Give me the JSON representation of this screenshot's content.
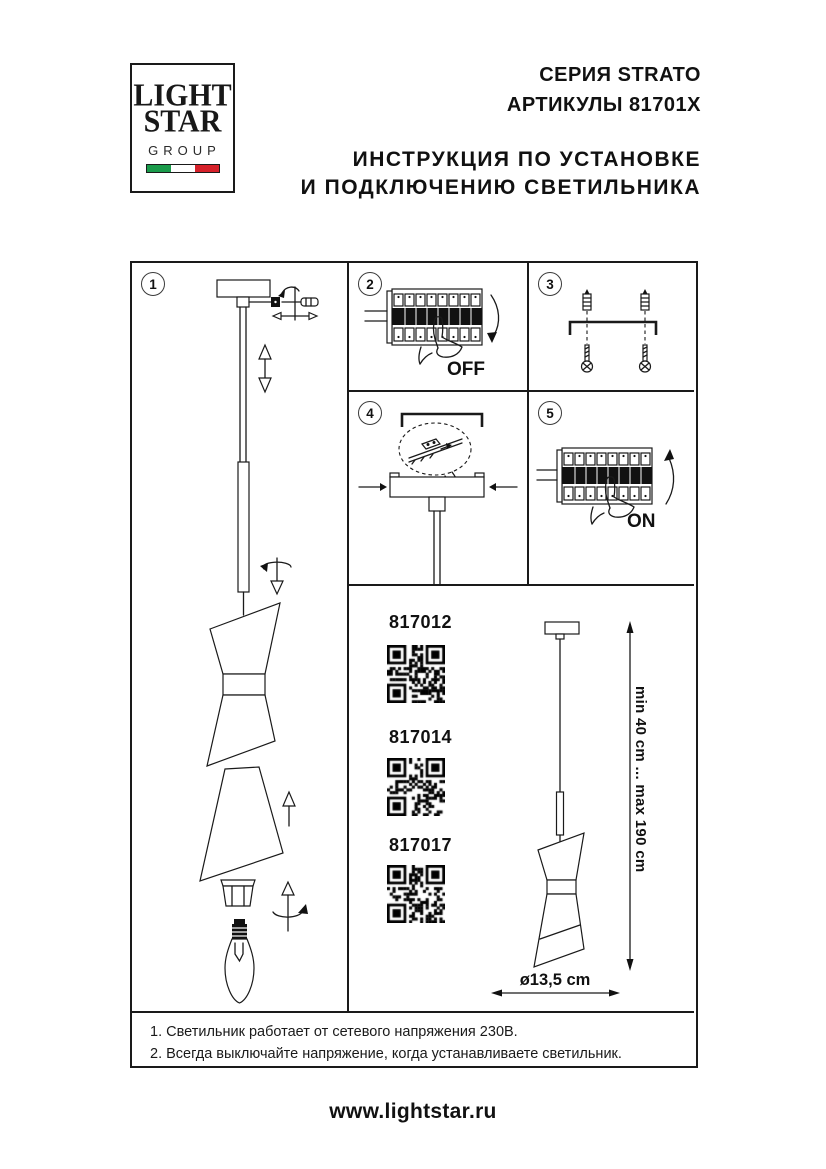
{
  "logo": {
    "line1": "LIGHT",
    "line2": "STAR",
    "line3": "GROUP",
    "flag_colors": [
      "#1a9b4b",
      "#ffffff",
      "#d6212a"
    ]
  },
  "header": {
    "series": "СЕРИЯ STRATO",
    "articles": "АРТИКУЛЫ 81701X",
    "title_line1": "ИНСТРУКЦИЯ ПО УСТАНОВКЕ",
    "title_line2": "И ПОДКЛЮЧЕНИЮ СВЕТИЛЬНИКА"
  },
  "steps": [
    {
      "number": "1"
    },
    {
      "number": "2",
      "label": "OFF"
    },
    {
      "number": "3"
    },
    {
      "number": "4"
    },
    {
      "number": "5",
      "label": "ON"
    }
  ],
  "products": [
    {
      "article": "817012"
    },
    {
      "article": "817014"
    },
    {
      "article": "817017"
    }
  ],
  "dimensions": {
    "height_range": "min 40 cm ... max 190 cm",
    "diameter": "ø13,5 cm"
  },
  "footnotes": [
    "1. Светильник работает от сетевого напряжения 230В.",
    "2. Всегда выключайте напряжение, когда устанавливаете светильник."
  ],
  "page": {
    "website": "www.lightstar.ru"
  }
}
